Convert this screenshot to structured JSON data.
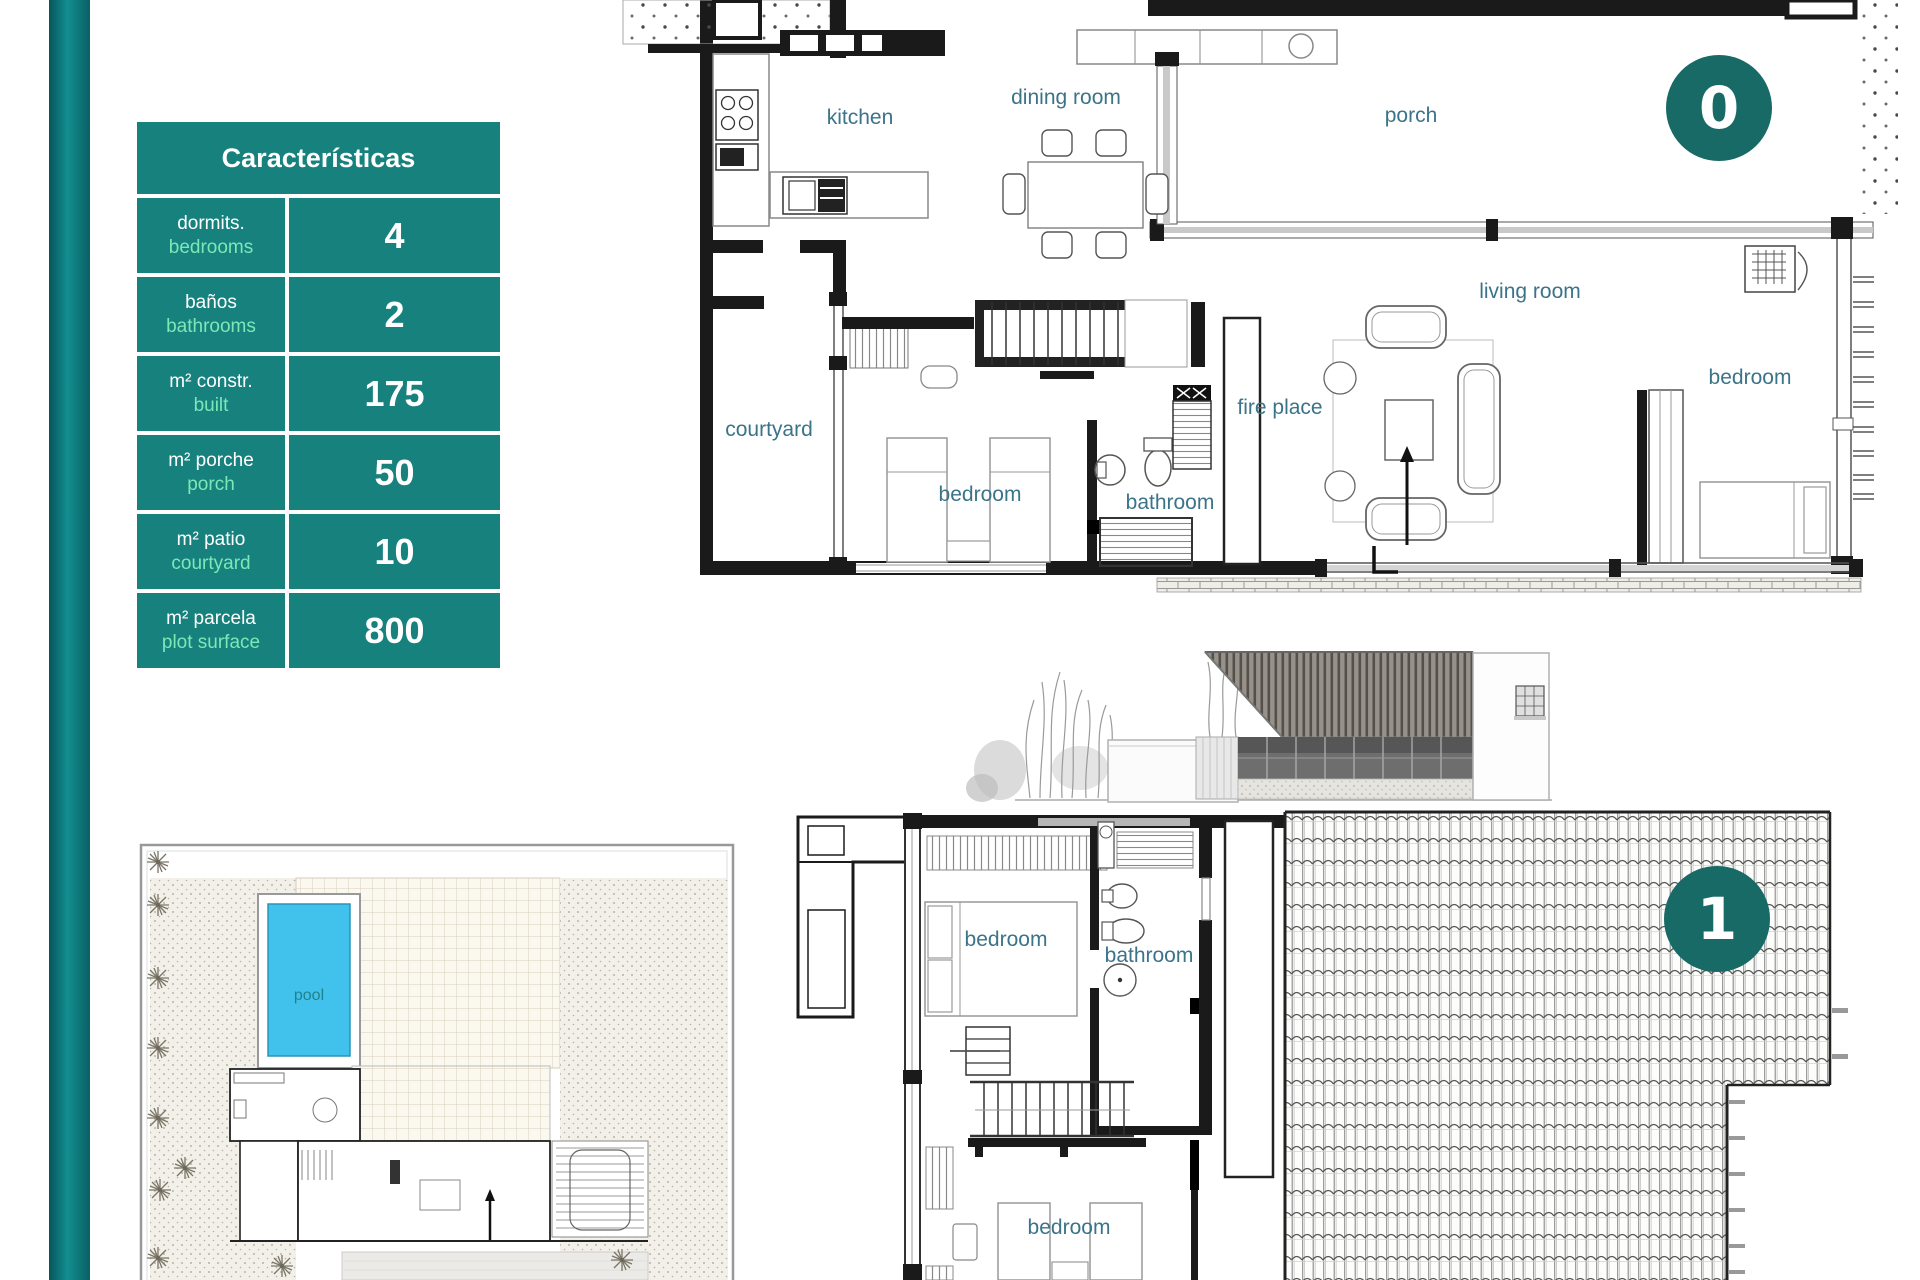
{
  "characteristics_table": {
    "title": "Características",
    "rows": [
      {
        "label_es": "dormits.",
        "label_en": "bedrooms",
        "value": "4"
      },
      {
        "label_es": "baños",
        "label_en": "bathrooms",
        "value": "2"
      },
      {
        "label_es": "m² constr.",
        "label_en": "built",
        "value": "175"
      },
      {
        "label_es": "m² porche",
        "label_en": "porch",
        "value": "50"
      },
      {
        "label_es": "m² patio",
        "label_en": "courtyard",
        "value": "10"
      },
      {
        "label_es": "m² parcela",
        "label_en": "plot surface",
        "value": "800"
      }
    ]
  },
  "floor0": {
    "badge": "0",
    "labels": {
      "kitchen": "kitchen",
      "dining_room": "dining room",
      "porch": "porch",
      "living_room": "living room",
      "fire_place": "fire place",
      "bedroom_right": "bedroom",
      "courtyard": "courtyard",
      "bedroom_left": "bedroom",
      "bathroom": "bathroom"
    }
  },
  "floor1": {
    "badge": "1",
    "labels": {
      "bedroom_top": "bedroom",
      "bathroom": "bathroom",
      "bedroom_bottom": "bedroom"
    }
  },
  "site_plan": {
    "pool_label": "pool"
  },
  "colors": {
    "table_teal": "#17817e",
    "accent_mint": "#7de8b6",
    "badge_teal": "#186a66",
    "room_label": "#3b7489",
    "pool_blue": "#41c2ec"
  }
}
